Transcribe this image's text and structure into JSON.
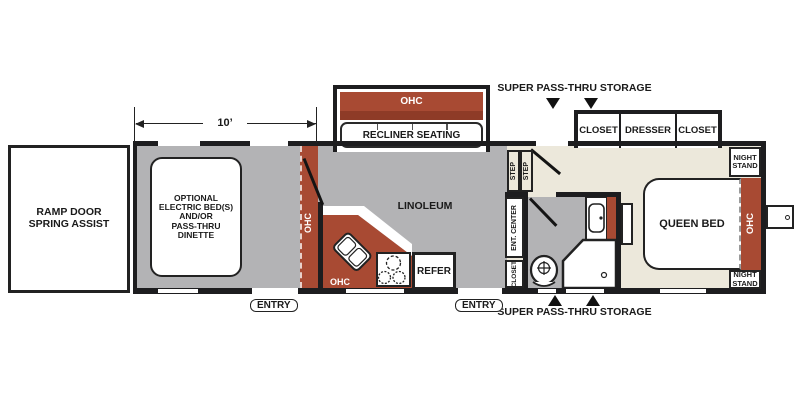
{
  "colors": {
    "accent-red": "#a84a33",
    "accent-red-dark": "#8e3b27",
    "floor-gray": "#b3b3b5",
    "floor-cream": "#ece8db",
    "wall": "#1d1d1f",
    "text": "#1a1a1a"
  },
  "plan": {
    "dimension": {
      "label": "10’"
    },
    "garage": {
      "ramp_door": "RAMP DOOR\nSPRING ASSIST",
      "option": "OPTIONAL\nELECTRIC BED(S)\nAND/OR\nPASS-THRU\nDINETTE",
      "ohc": "OHC",
      "entry": "ENTRY"
    },
    "living": {
      "slide_ohc": "OHC",
      "recliner": "RECLINER SEATING",
      "floor": "LINOLEUM",
      "kitchen_ohc": "OHC",
      "refer": "REFER",
      "entry": "ENTRY"
    },
    "hall": {
      "step1": "STEP",
      "step2": "STEP",
      "ent_center": "ENT. CENTER",
      "closet": "CLOSET"
    },
    "bedroom": {
      "storage_top": "SUPER  PASS-THRU STORAGE",
      "storage_bottom": "SUPER  PASS-THRU STORAGE",
      "closet_left": "CLOSET",
      "dresser": "DRESSER",
      "closet_right": "CLOSET",
      "bed": "QUEEN BED",
      "ohc": "OHC",
      "night_stand": "NIGHT\nSTAND"
    }
  }
}
